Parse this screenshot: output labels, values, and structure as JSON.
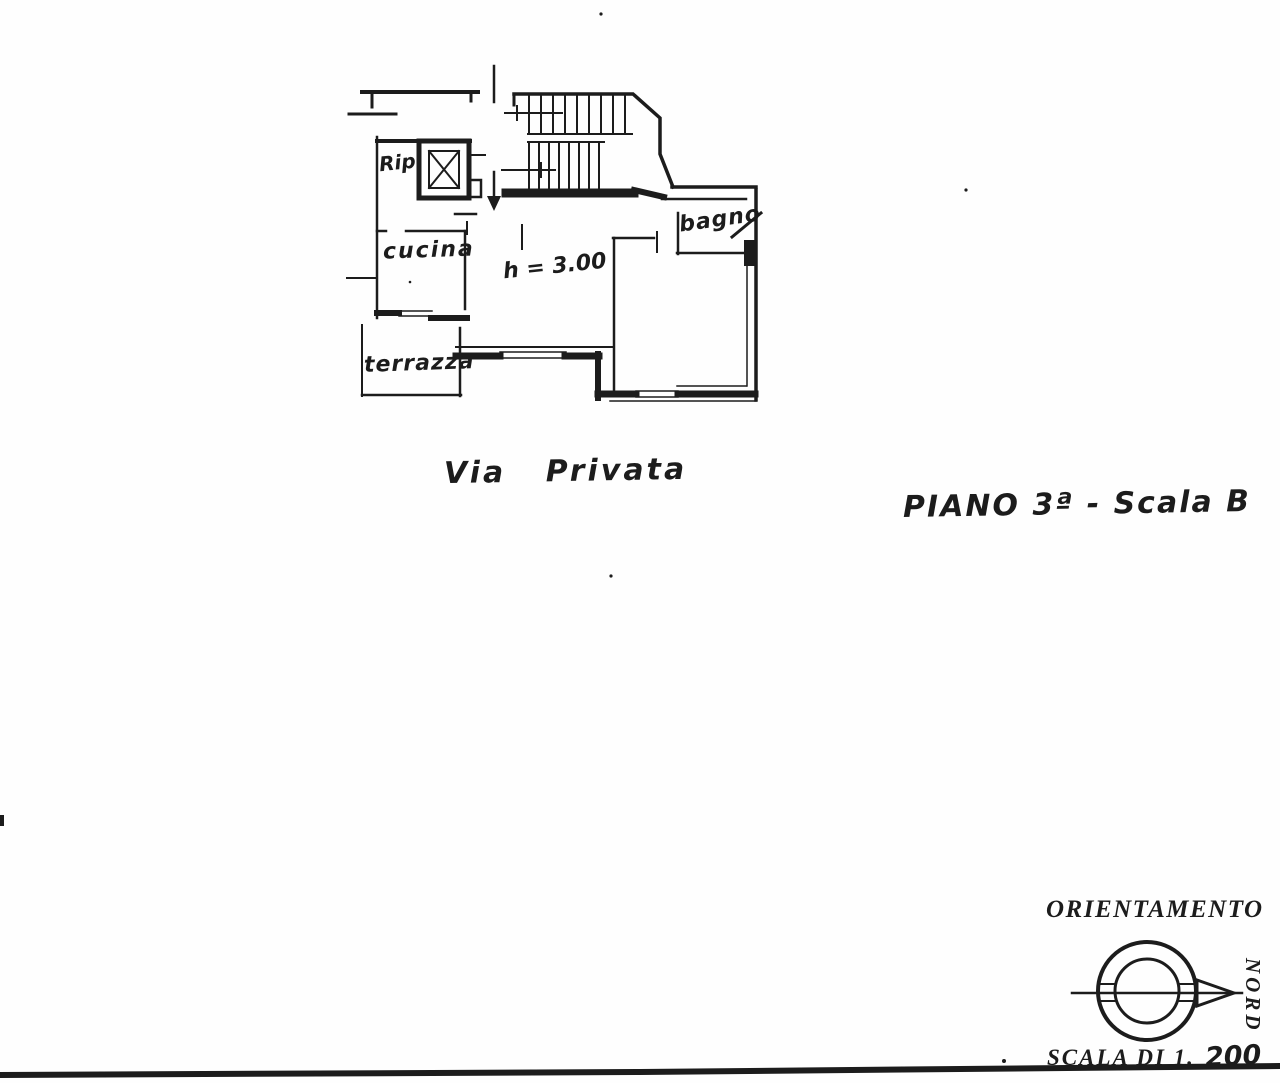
{
  "scan": {
    "ink": "#1c1c1c",
    "paper": "#fefefe"
  },
  "plan": {
    "room_labels": {
      "rip": "Rip.",
      "cucina": "cucina",
      "terrazza": "terrazza",
      "bagno": "bagno"
    },
    "height_note": "h = 3.00",
    "street_label": "Via Privata",
    "floor_title": "PIANO 3ª - Scala B"
  },
  "orientation": {
    "title": "ORIENTAMENTO",
    "north_label": "NORD",
    "scale_text": "SCALA DI 1.",
    "scale_value": "200"
  }
}
